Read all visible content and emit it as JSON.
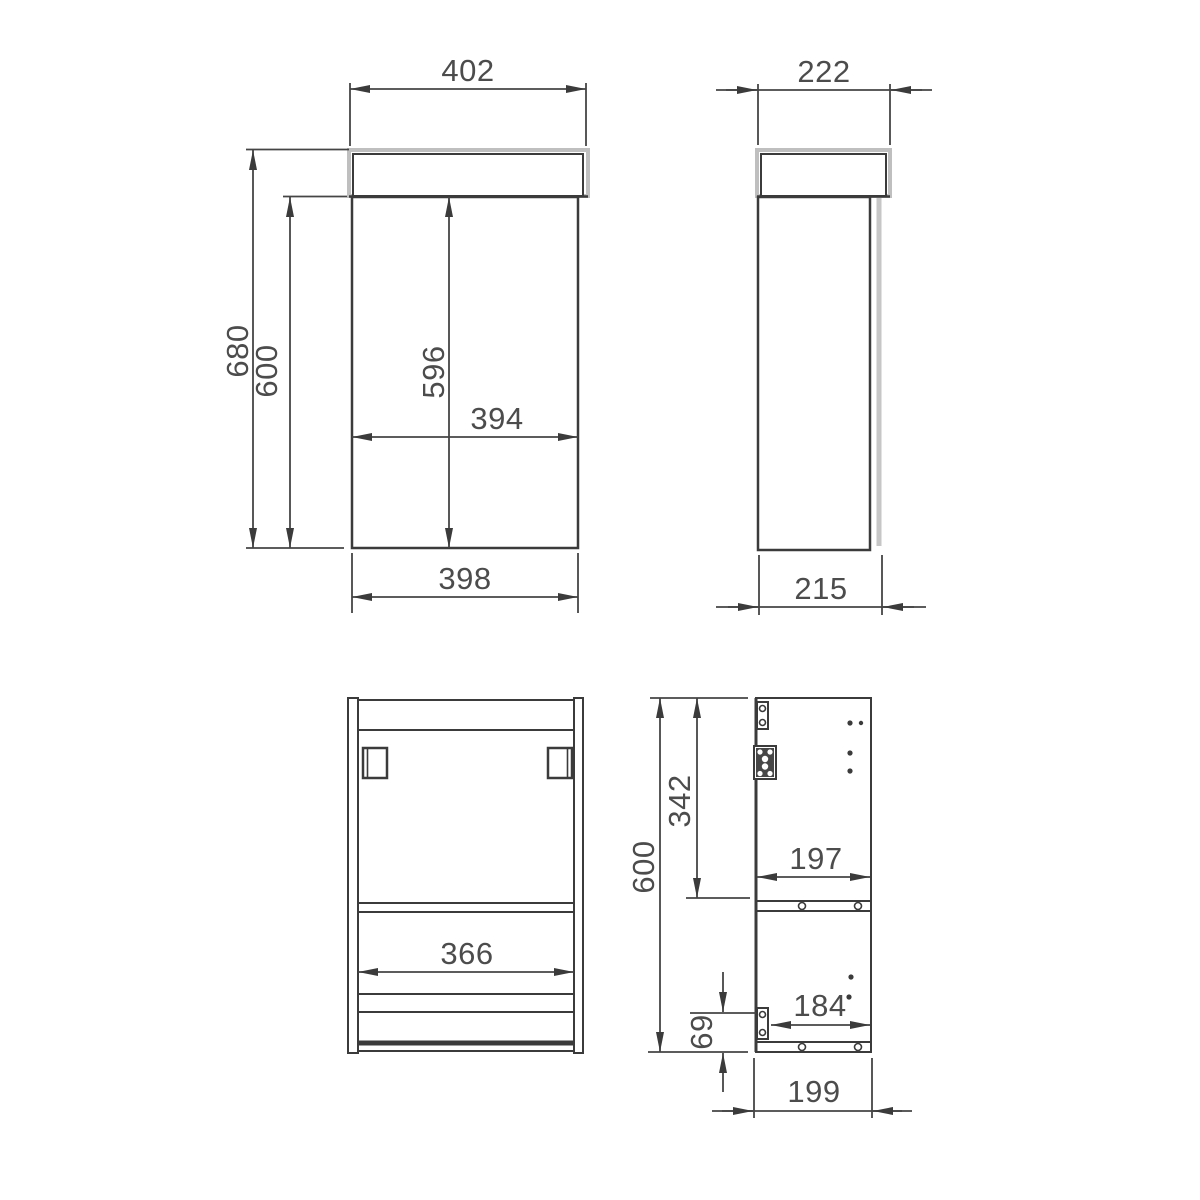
{
  "drawing": {
    "title": "vanity-unit-technical-drawing",
    "colors": {
      "line": "#3b3b3b",
      "dim_line": "#454545",
      "text": "#4c4c4c",
      "light_grey": "#bfbfbf",
      "background": "#ffffff"
    },
    "views": {
      "front": {
        "name": "front-view",
        "dims": {
          "top_width": "402",
          "total_height": "680",
          "carcass_height": "600",
          "door_height": "596",
          "mid_width": "394",
          "bottom_width": "398"
        }
      },
      "side": {
        "name": "side-view",
        "dims": {
          "top_depth": "222",
          "bottom_depth": "215"
        }
      },
      "back": {
        "name": "back-view",
        "dims": {
          "inner_width": "366"
        }
      },
      "section": {
        "name": "section-view",
        "dims": {
          "total_height": "600",
          "upper_height": "342",
          "shelf_width": "197",
          "lower_width": "184",
          "plinth_height": "69",
          "bottom_depth": "199"
        }
      }
    }
  }
}
